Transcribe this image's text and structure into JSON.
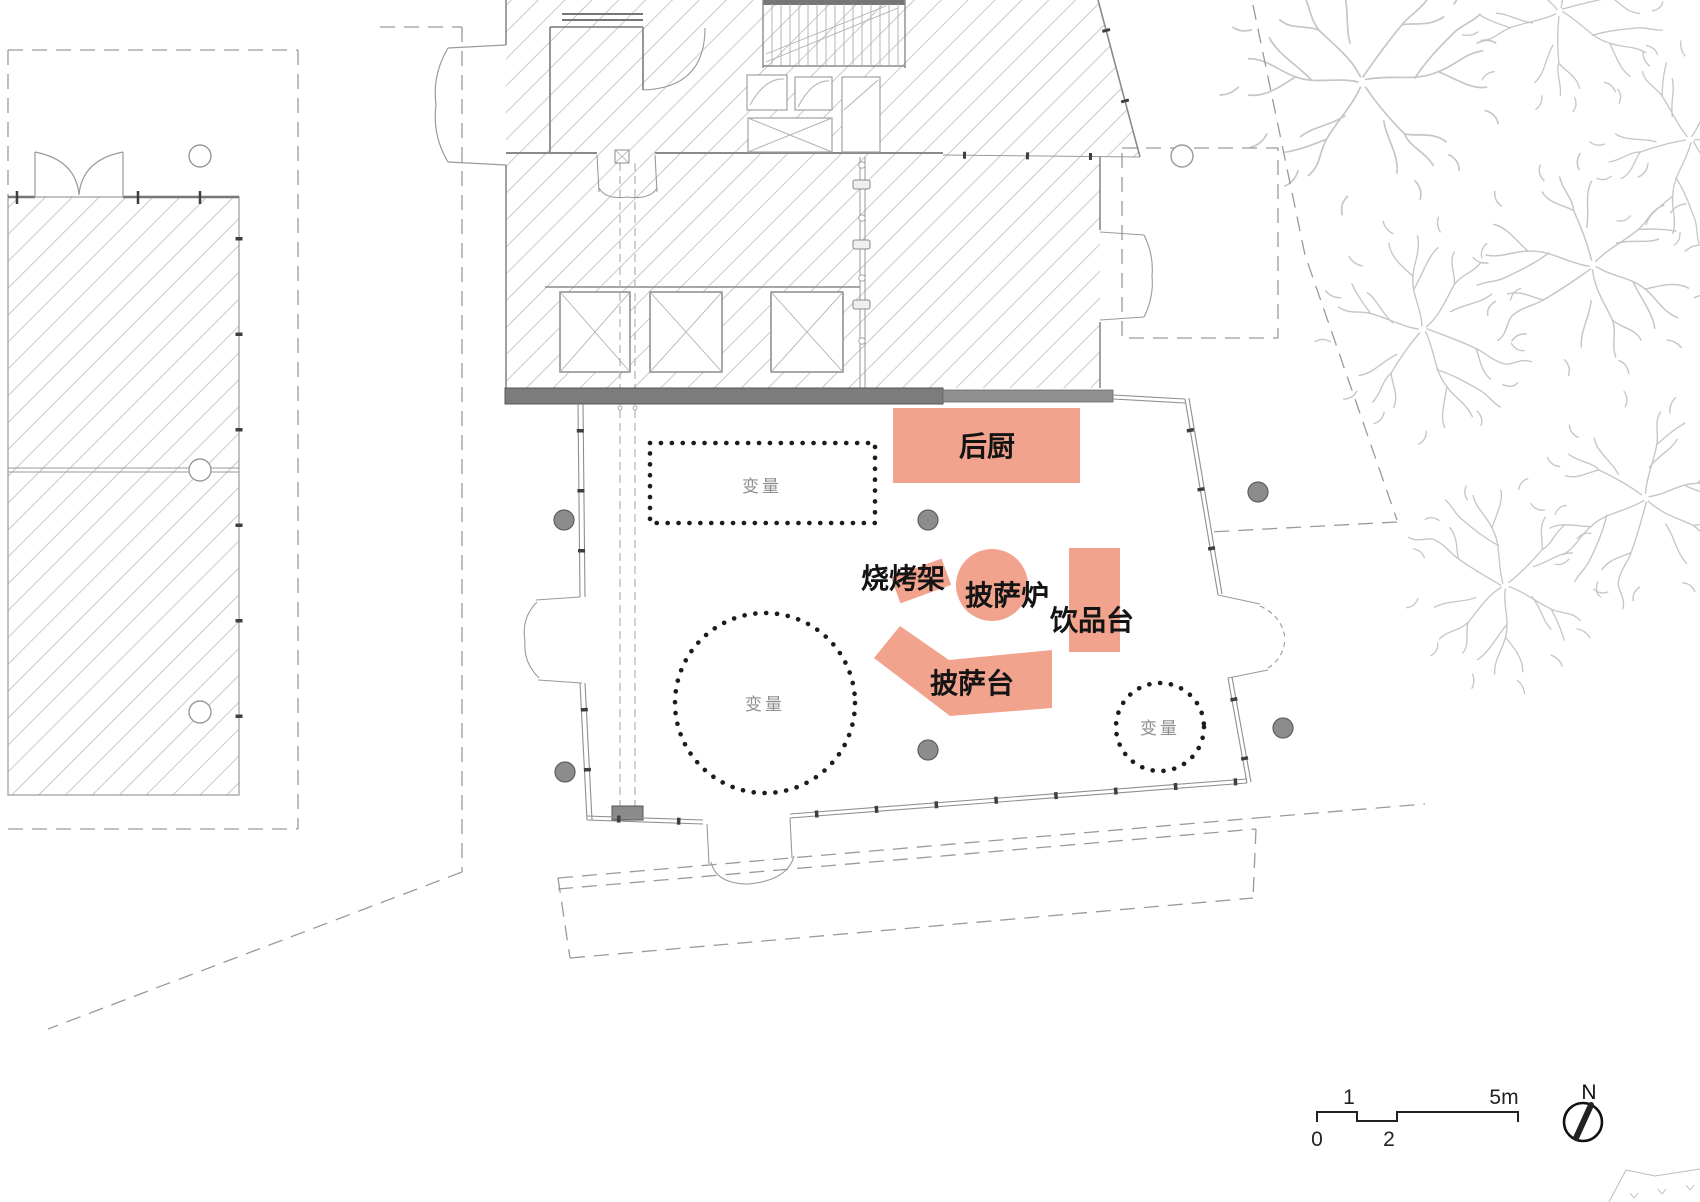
{
  "zones": {
    "kitchen": "后厨",
    "grill": "烧烤架",
    "pizza_oven": "披萨炉",
    "drink_station": "饮品台",
    "pizza_table": "披萨台"
  },
  "variable_label": "变量",
  "scale_bar": {
    "tick_0": "0",
    "tick_1": "1",
    "tick_2": "2",
    "tick_5m": "5m"
  },
  "north_arrow": {
    "label": "N"
  },
  "colors": {
    "zone_fill": "#F1A38D",
    "wall_dark": "#7C7C7C",
    "wall_medium": "#909090",
    "hatch_line": "#C9C9C9",
    "dot_column": "#8C8C8C",
    "variable_dot": "#1C1C1C",
    "tree_line": "#C3C7C7",
    "boundary_dash": "#9A9A9A"
  }
}
